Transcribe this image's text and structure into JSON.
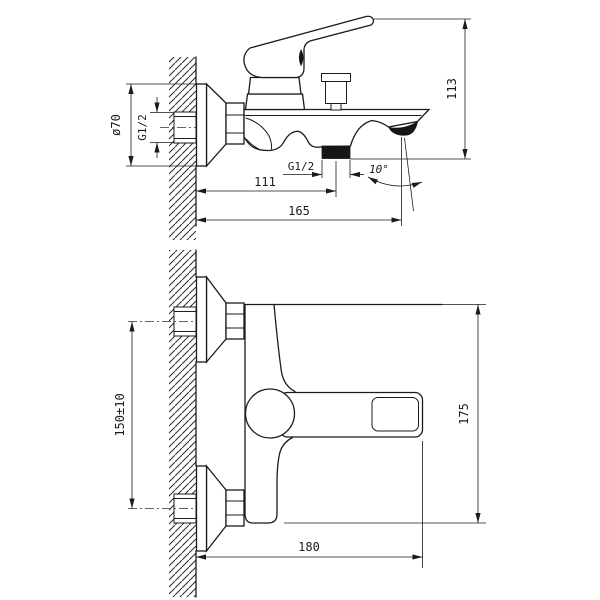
{
  "side_view": {
    "label_flange_diameter": "ø70",
    "label_inlet_thread": "G1/2",
    "label_height": "113",
    "label_shower_thread": "G1/2",
    "label_wall_to_outlet": "111",
    "label_spout_reach": "165",
    "label_spout_angle": "10°"
  },
  "front_view": {
    "label_inlet_centers": "150±10",
    "label_height": "175",
    "label_width": "180"
  }
}
